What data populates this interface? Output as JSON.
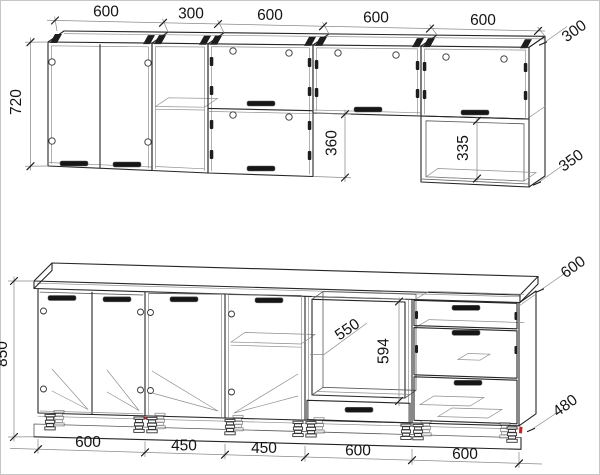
{
  "drawing": {
    "subject": "kitchen-cabinet-set-technical-drawing",
    "colors": {
      "line": "#262626",
      "background": "#ffffff",
      "accent_red": "#c42323"
    },
    "upper": {
      "widths": [
        "600",
        "300",
        "600",
        "600",
        "600"
      ],
      "height": "720",
      "flip_section_height": "360",
      "open_shelf_height": "335",
      "depth": "300",
      "shelf_depth": "350"
    },
    "lower": {
      "widths": [
        "600",
        "450",
        "450",
        "600",
        "600"
      ],
      "height": "850",
      "oven_niche_width": "550",
      "oven_niche_height": "594",
      "worktop_depth": "600",
      "plinth_depth": "480"
    }
  }
}
